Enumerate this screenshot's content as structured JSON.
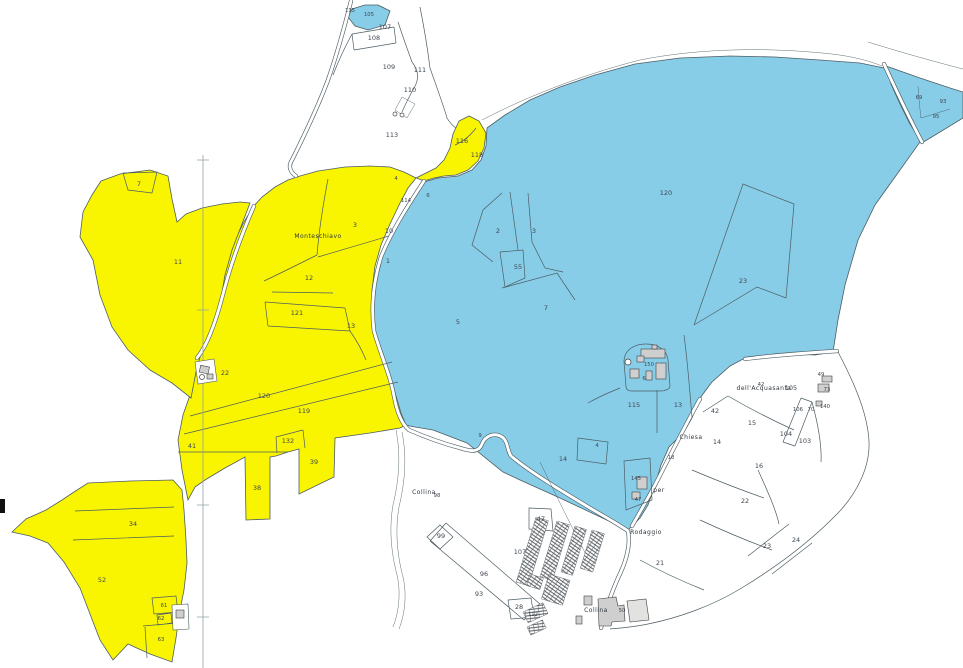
{
  "map": {
    "colors": {
      "background": "#ffffff",
      "zone_yellow": "#f9f500",
      "zone_blue": "#87cde8",
      "boundary_line": "#4d5d63",
      "building_fill": "#cfcfcf",
      "building_stroke": "#3f3f3f",
      "parcel_label": "#3e4650",
      "place_label": "#2f363d"
    },
    "parcel_labels": [
      {
        "text": "115",
        "x": 350,
        "y": 12,
        "s": 1
      },
      {
        "text": "105",
        "x": 369,
        "y": 16,
        "s": 1
      },
      {
        "text": "107",
        "x": 385,
        "y": 29
      },
      {
        "text": "108",
        "x": 374,
        "y": 40
      },
      {
        "text": "109",
        "x": 389,
        "y": 69
      },
      {
        "text": "111",
        "x": 420,
        "y": 72
      },
      {
        "text": "110",
        "x": 410,
        "y": 92
      },
      {
        "text": "113",
        "x": 392,
        "y": 137
      },
      {
        "text": "7",
        "x": 139,
        "y": 186
      },
      {
        "text": "11",
        "x": 178,
        "y": 264
      },
      {
        "text": "12",
        "x": 309,
        "y": 280
      },
      {
        "text": "121",
        "x": 297,
        "y": 315
      },
      {
        "text": "13",
        "x": 351,
        "y": 328
      },
      {
        "text": "3",
        "x": 355,
        "y": 227
      },
      {
        "text": "10",
        "x": 389,
        "y": 233
      },
      {
        "text": "1",
        "x": 388,
        "y": 263
      },
      {
        "text": "4",
        "x": 396,
        "y": 180,
        "s": 1
      },
      {
        "text": "6",
        "x": 428,
        "y": 197,
        "s": 1
      },
      {
        "text": "114",
        "x": 406,
        "y": 202,
        "s": 1
      },
      {
        "text": "116",
        "x": 462,
        "y": 143
      },
      {
        "text": "118",
        "x": 477,
        "y": 157
      },
      {
        "text": "22",
        "x": 225,
        "y": 375
      },
      {
        "text": "120",
        "x": 264,
        "y": 398
      },
      {
        "text": "119",
        "x": 304,
        "y": 413
      },
      {
        "text": "41",
        "x": 192,
        "y": 448
      },
      {
        "text": "132",
        "x": 288,
        "y": 443
      },
      {
        "text": "39",
        "x": 314,
        "y": 464
      },
      {
        "text": "38",
        "x": 257,
        "y": 490
      },
      {
        "text": "34",
        "x": 133,
        "y": 526
      },
      {
        "text": "52",
        "x": 102,
        "y": 582
      },
      {
        "text": "61",
        "x": 164,
        "y": 607,
        "s": 1
      },
      {
        "text": "62",
        "x": 161,
        "y": 620,
        "s": 1
      },
      {
        "text": "63",
        "x": 161,
        "y": 641,
        "s": 1
      },
      {
        "text": "120",
        "x": 666,
        "y": 195
      },
      {
        "text": "23",
        "x": 743,
        "y": 283
      },
      {
        "text": "2",
        "x": 498,
        "y": 233
      },
      {
        "text": "3",
        "x": 534,
        "y": 233
      },
      {
        "text": "55",
        "x": 518,
        "y": 269
      },
      {
        "text": "7",
        "x": 546,
        "y": 310
      },
      {
        "text": "5",
        "x": 458,
        "y": 324
      },
      {
        "text": "115",
        "x": 634,
        "y": 407
      },
      {
        "text": "13",
        "x": 678,
        "y": 407
      },
      {
        "text": "150",
        "x": 649,
        "y": 366,
        "s": 1
      },
      {
        "text": "6",
        "x": 644,
        "y": 380,
        "s": 1
      },
      {
        "text": "9",
        "x": 480,
        "y": 437,
        "s": 1
      },
      {
        "text": "14",
        "x": 563,
        "y": 461
      },
      {
        "text": "4",
        "x": 597,
        "y": 447,
        "s": 1
      },
      {
        "text": "145",
        "x": 636,
        "y": 480,
        "s": 1
      },
      {
        "text": "47",
        "x": 638,
        "y": 501,
        "s": 1
      },
      {
        "text": "69",
        "x": 919,
        "y": 99,
        "s": 1
      },
      {
        "text": "93",
        "x": 943,
        "y": 103,
        "s": 1
      },
      {
        "text": "95",
        "x": 936,
        "y": 118,
        "s": 1
      },
      {
        "text": "98",
        "x": 437,
        "y": 497,
        "s": 1
      },
      {
        "text": "99",
        "x": 441,
        "y": 538
      },
      {
        "text": "96",
        "x": 484,
        "y": 576
      },
      {
        "text": "93",
        "x": 479,
        "y": 596
      },
      {
        "text": "28",
        "x": 519,
        "y": 609
      },
      {
        "text": "112",
        "x": 533,
        "y": 616,
        "s": 1
      },
      {
        "text": "47",
        "x": 541,
        "y": 521
      },
      {
        "text": "107",
        "x": 520,
        "y": 554
      },
      {
        "text": "50",
        "x": 622,
        "y": 612,
        "s": 1
      },
      {
        "text": "21",
        "x": 660,
        "y": 565
      },
      {
        "text": "22",
        "x": 745,
        "y": 503
      },
      {
        "text": "23",
        "x": 767,
        "y": 548
      },
      {
        "text": "24",
        "x": 796,
        "y": 542
      },
      {
        "text": "18",
        "x": 671,
        "y": 459,
        "s": 1
      },
      {
        "text": "14",
        "x": 717,
        "y": 444
      },
      {
        "text": "15",
        "x": 752,
        "y": 425
      },
      {
        "text": "16",
        "x": 759,
        "y": 468
      },
      {
        "text": "104",
        "x": 786,
        "y": 436
      },
      {
        "text": "103",
        "x": 805,
        "y": 443
      },
      {
        "text": "42",
        "x": 715,
        "y": 413
      },
      {
        "text": "42",
        "x": 761,
        "y": 386,
        "s": 1
      },
      {
        "text": "105",
        "x": 791,
        "y": 390
      },
      {
        "text": "106",
        "x": 798,
        "y": 411,
        "s": 1
      },
      {
        "text": "70",
        "x": 811,
        "y": 411,
        "s": 1
      },
      {
        "text": "140",
        "x": 825,
        "y": 408,
        "s": 1
      },
      {
        "text": "49",
        "x": 821,
        "y": 376,
        "s": 1
      },
      {
        "text": "73",
        "x": 827,
        "y": 391,
        "s": 1
      }
    ],
    "place_labels": [
      {
        "text": "Monteschiavo",
        "x": 318,
        "y": 238
      },
      {
        "text": "Collina",
        "x": 424,
        "y": 494
      },
      {
        "text": "Collina",
        "x": 596,
        "y": 612
      },
      {
        "text": "Chiesa",
        "x": 691,
        "y": 439
      },
      {
        "text": "dell'Acquasanta",
        "x": 764,
        "y": 390
      },
      {
        "text": "per",
        "x": 659,
        "y": 492
      },
      {
        "text": "Rodaggio",
        "x": 646,
        "y": 534
      }
    ]
  }
}
